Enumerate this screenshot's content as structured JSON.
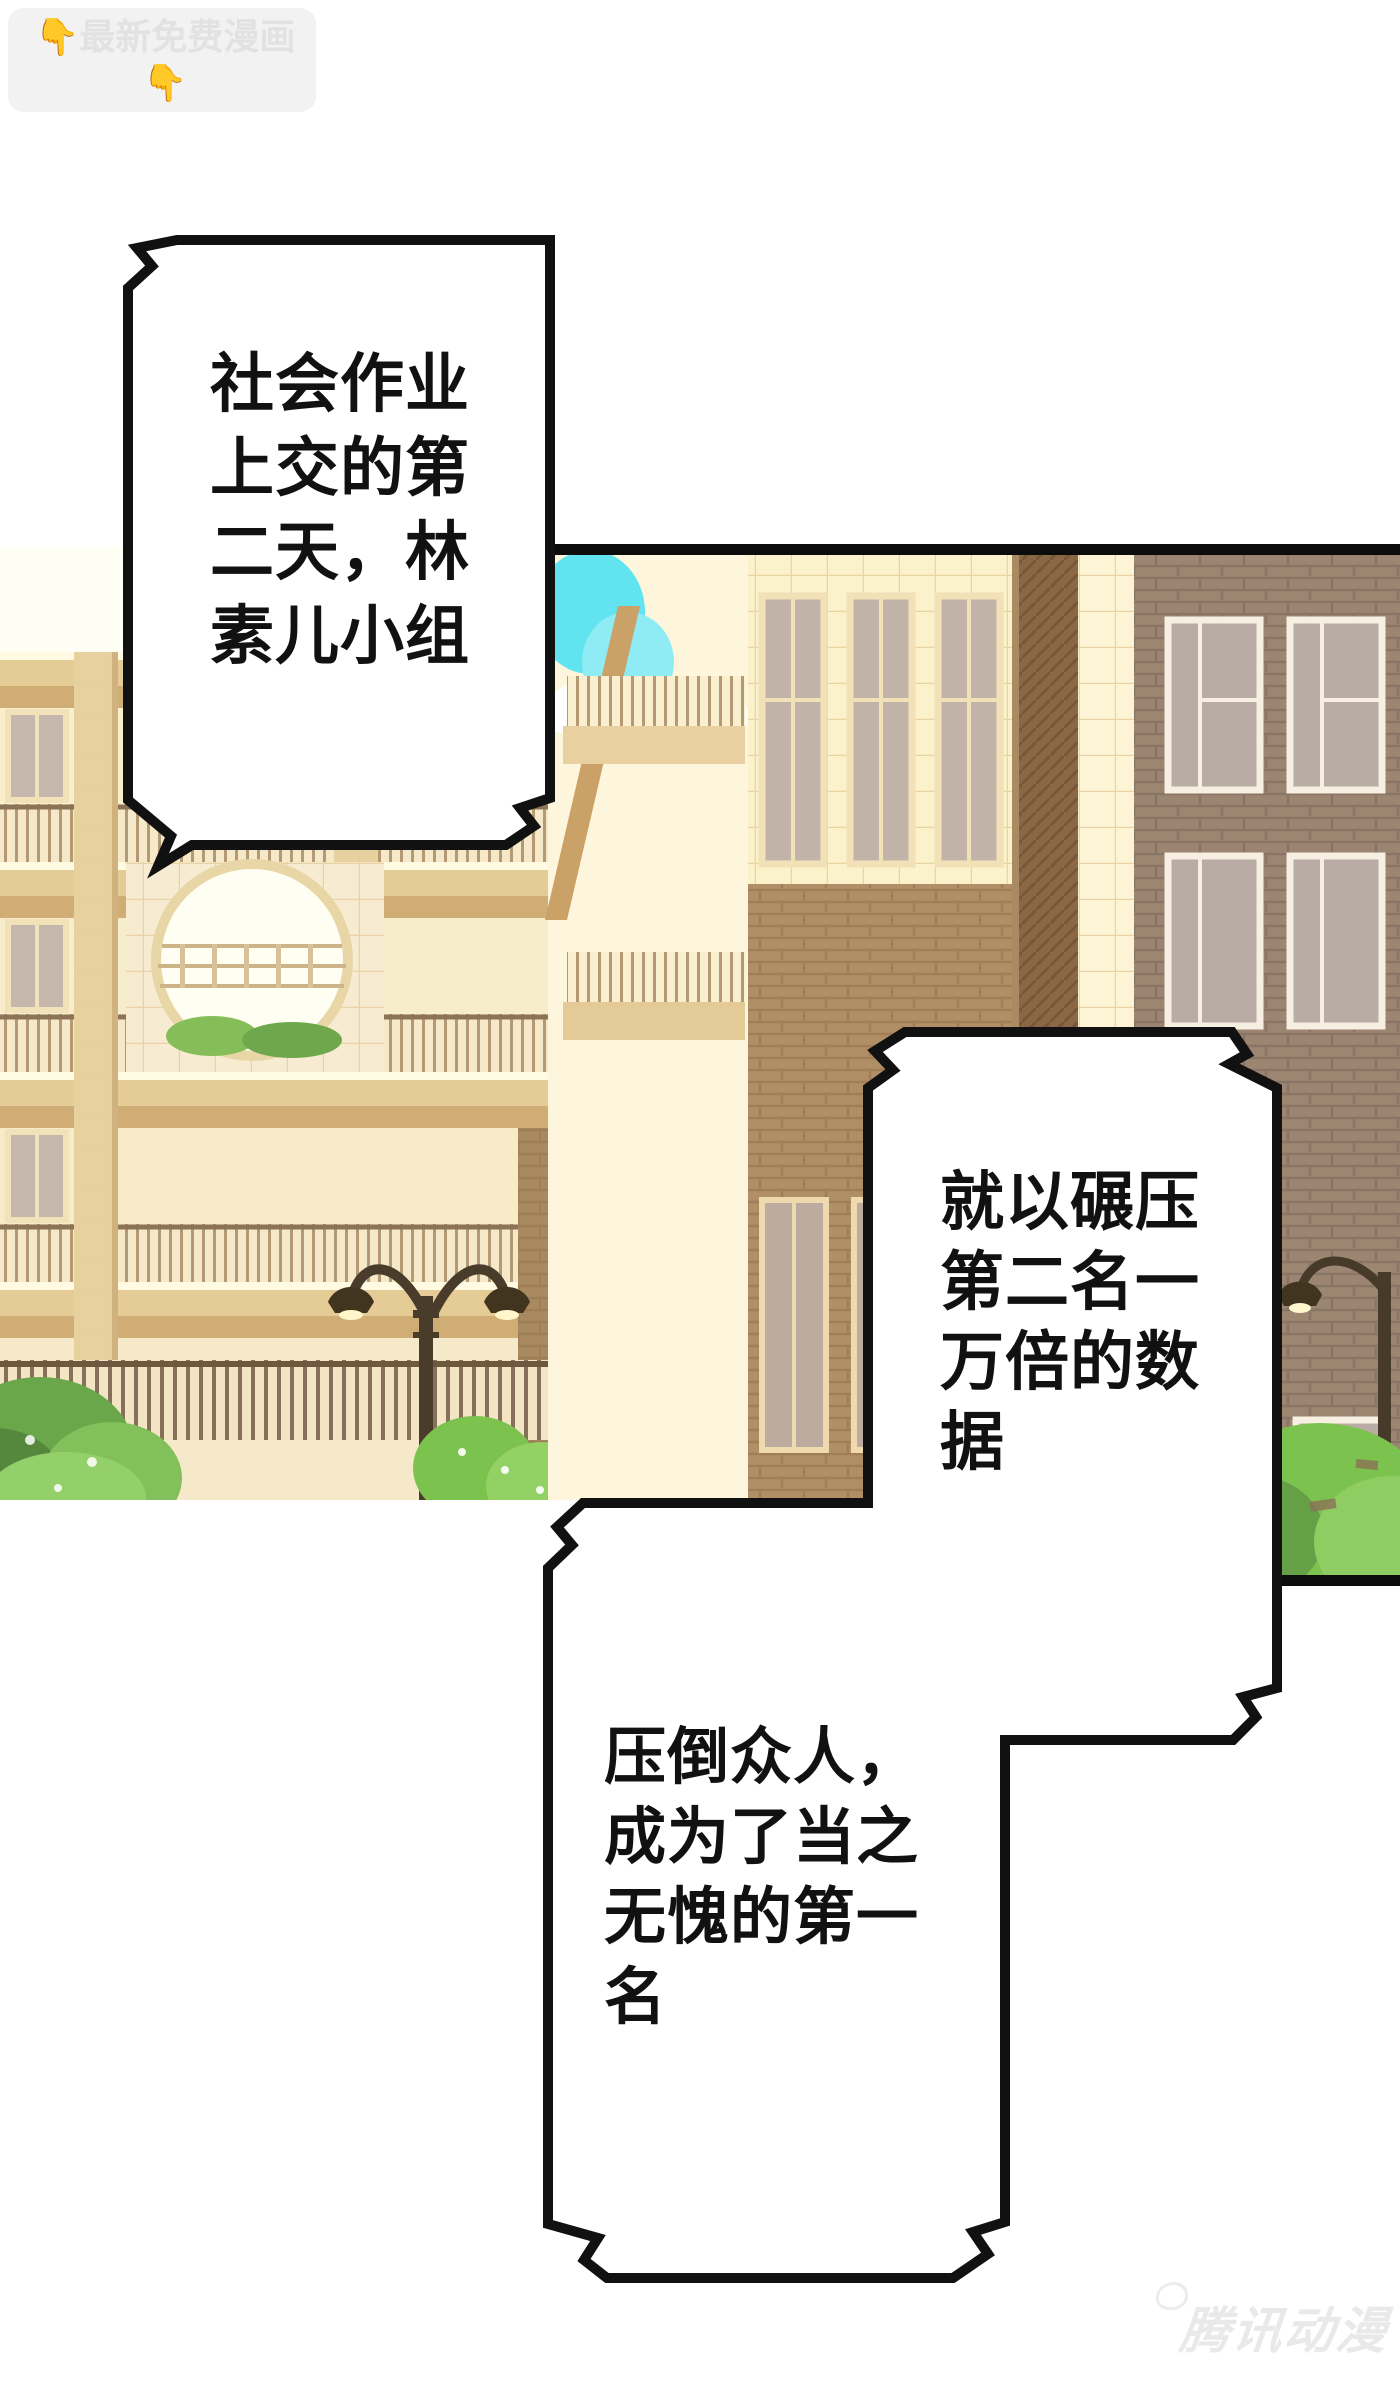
{
  "watermark_top": {
    "line1": "👇最新免费漫画👇",
    "line2": "www.baozimh.com"
  },
  "watermark_bottom": {
    "label": "腾讯动漫"
  },
  "bubbles": {
    "b1": {
      "lines": [
        "社会作业",
        "上交的第",
        "二天，林",
        "素儿小组"
      ]
    },
    "b2": {
      "lines": [
        "就以碾压",
        "第二名一",
        "万倍的数",
        "据"
      ]
    },
    "b3": {
      "lines": [
        "压倒众人，",
        "成为了当之",
        "无愧的第一",
        "名"
      ]
    }
  },
  "colors": {
    "page_bg": "#ffffff",
    "bubble_fill": "#ffffff",
    "bubble_stroke": "#111111",
    "panel_border": "#0c0c0c",
    "wall_cream": "#f9efcd",
    "slab_tan": "#cfad74",
    "tile_bright": "#fbf1ca",
    "brick_warm": "#b08e66",
    "brick_gray": "#9c8672",
    "window_glass": "#c2b3a9",
    "sky_cyan": "#62e4f0",
    "bush_green": "#7cc24e",
    "lamp_dark": "#4a3c2b",
    "watermark_gray": "#e2e2e2"
  }
}
